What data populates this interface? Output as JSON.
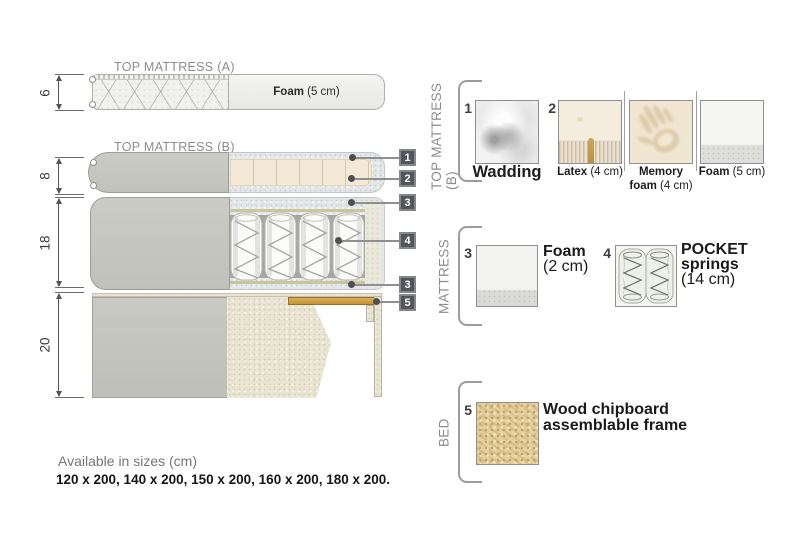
{
  "colors": {
    "cover_gray": "#c6c6c0",
    "wadding_speckle": "#e4e7e9",
    "foam_cream": "#f4e9d6",
    "bed_beige": "#eae5d3",
    "wood_slat": "#cfa046",
    "marker_badge": "#54555a",
    "label_gray": "#8c8c8c"
  },
  "diagram": {
    "title_a": "TOP MATTRESS (A)",
    "title_b": "TOP MATTRESS (B)",
    "foam_a": {
      "bold": "Foam",
      "rest": " (5 cm)"
    },
    "dimensions": [
      {
        "value": "6"
      },
      {
        "value": "8"
      },
      {
        "value": "18"
      },
      {
        "value": "20"
      }
    ],
    "markers": [
      {
        "n": "1"
      },
      {
        "n": "2"
      },
      {
        "n": "3"
      },
      {
        "n": "4"
      },
      {
        "n": "3"
      },
      {
        "n": "5"
      }
    ]
  },
  "legend": {
    "sections": [
      {
        "label": "TOP MATTRESS (B)",
        "panels": [
          {
            "num": "1",
            "bold": "Wadding",
            "rest": ""
          },
          {
            "num": "2",
            "bold": "Latex",
            "rest": " (4 cm)"
          },
          {
            "num": "",
            "bold1": "Memory",
            "bold2": "foam",
            "rest": " (4 cm)"
          },
          {
            "num": "",
            "bold": "Foam",
            "rest": " (5 cm)"
          }
        ]
      },
      {
        "label": "MATTRESS",
        "panels": [
          {
            "num": "3",
            "bold": "Foam",
            "rest": "(2 cm)"
          },
          {
            "num": "4",
            "bold1": "POCKET",
            "bold2": "springs",
            "rest": "(14 cm)"
          }
        ]
      },
      {
        "label": "BED",
        "panels": [
          {
            "num": "5",
            "line1": "Wood chipboard",
            "line2": "assemblable frame"
          }
        ]
      }
    ]
  },
  "footer": {
    "title": "Available in sizes (cm)",
    "sizes": "120 x 200, 140 x 200, 150 x 200, 160 x 200, 180 x 200."
  }
}
